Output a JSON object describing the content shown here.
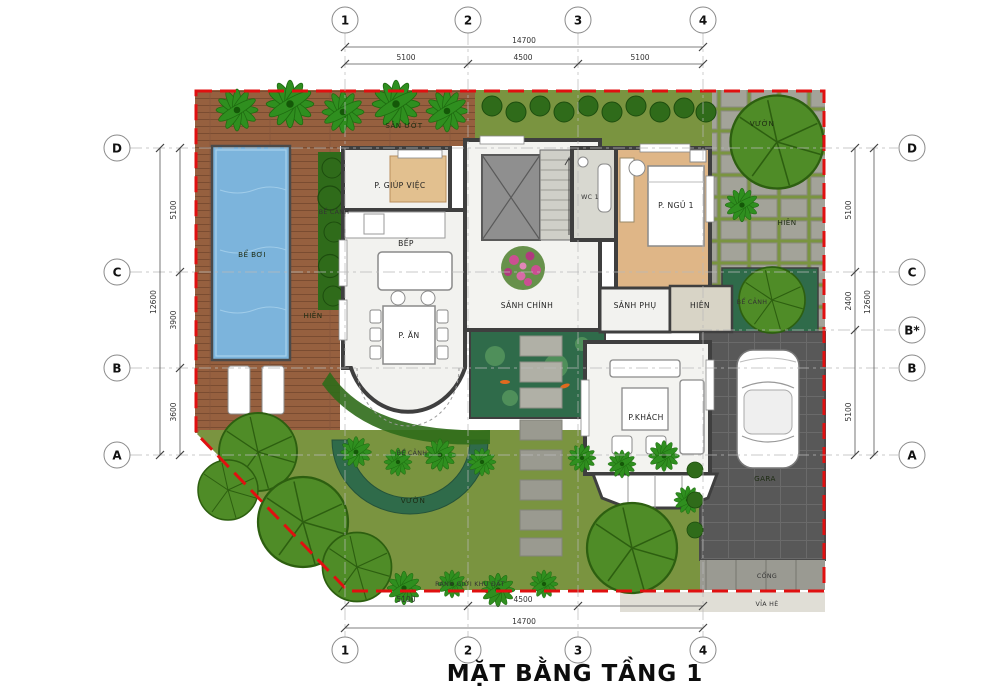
{
  "title": "MẶT BẰNG TẦNG 1",
  "grid": {
    "cols": [
      "1",
      "2",
      "3",
      "4"
    ],
    "rows_left": [
      "D",
      "C",
      "B",
      "A"
    ],
    "rows_right": [
      "D",
      "C",
      "B*",
      "B",
      "A"
    ]
  },
  "dims": {
    "top": {
      "total": "14700",
      "segments": [
        "5100",
        "4500",
        "5100"
      ]
    },
    "bottom": {
      "total": "14700",
      "segments": [
        "5100",
        "4500"
      ]
    },
    "left": {
      "total": "12600",
      "segments": [
        "5100",
        "3900",
        "3600"
      ]
    },
    "right": {
      "total": "12600",
      "segments": [
        "5100",
        "2400",
        "5100"
      ]
    }
  },
  "rooms": {
    "p_giup_viec": "P. GIÚP VIỆC",
    "bep": "BẾP",
    "p_an": "P. ĂN",
    "sanh_chinh": "SẢNH CHÍNH",
    "wc1": "WC 1",
    "p_ngu_1": "P. NGỦ 1",
    "sanh_phu": "SẢNH PHỤ",
    "hien_phu": "HIÊN",
    "p_khach": "P.KHÁCH"
  },
  "site": {
    "san_uot": "SÂN ƯỚT",
    "be_boi": "BỂ BƠI",
    "be_canh_left": "BỂ CẢNH",
    "hien_left": "HIÊN",
    "vuon_top": "VƯỜN",
    "hien_top": "HIÊN",
    "be_canh_right": "BỂ CẢNH",
    "be_canh_bottom": "BỂ CẢNH",
    "vuon_bottom": "VƯỜN",
    "gara": "GARA",
    "cong": "CỔNG",
    "via_he": "VỈA HÈ",
    "ranh_gioi": "RANH GIỚI KHU ĐẤT"
  },
  "colors": {
    "boundary_red": "#e01010",
    "pool_blue": "#7cb4dc",
    "grass_green": "#7a9440",
    "canopy_green": "#4f8c27",
    "deck_wood": "#96603f",
    "bedroom_wood": "#dfb687",
    "wall_gray": "#3f3f3f",
    "garage_gray": "#585858",
    "pond_green": "#2f6b4a",
    "flower_pink": "#cc4f92"
  }
}
